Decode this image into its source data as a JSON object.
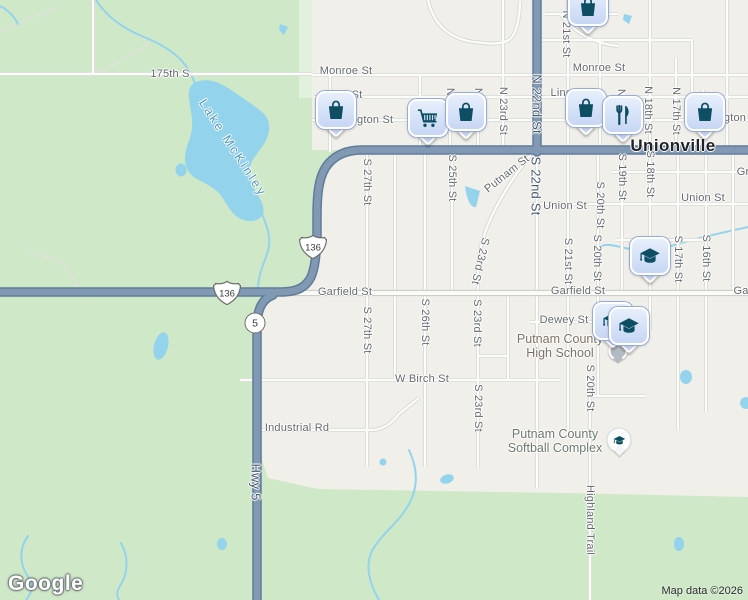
{
  "city_label": "Unionville",
  "water": {
    "lake": "Lake McKinley"
  },
  "pois": {
    "high_school": {
      "line1": "Putnam County",
      "line2": "High School"
    },
    "softball_complex": {
      "line1": "Putnam County",
      "line2": "Softball Complex"
    }
  },
  "routes": {
    "hwy5": "Hwy 5",
    "n22nd": "N 22nd St",
    "s22nd": "S 22nd St"
  },
  "shields": {
    "us136": "136",
    "route5": "5"
  },
  "streets": {
    "s175th": "175th S",
    "monroe": "Monroe St",
    "linc_partial": "Linc",
    "st_partial": "St",
    "ngton_partial": "ngton St",
    "gton_partial": "gton",
    "gr_partial": "Gr",
    "gar_partial": "Gar",
    "union": "Union St",
    "garfield": "Garfield St",
    "dewey": "Dewey St",
    "wbirch": "W Birch St",
    "industrial": "Industrial Rd",
    "putnam": "Putnam St",
    "highland": "Highland Trail",
    "n_partial": "N",
    "n21st": "N 21st St",
    "n23rd": "N 23rd St",
    "n18th": "N 18th St",
    "n17th": "N 17th St",
    "s27th": "S 27th St",
    "s26th": "S 26th St",
    "s25th": "S 25th St",
    "s23rd": "S 23rd St",
    "s21st": "S 21st St",
    "s20th": "S 20th St",
    "s19th": "S 19th St",
    "s18th": "S 18th St",
    "s17th": "S 17th St",
    "s16th": "S 16th St"
  },
  "marker_icons": {
    "bag": "shopping-bag",
    "cart": "shopping-cart",
    "restaurant": "fork-and-knife",
    "education": "graduation-cap"
  },
  "colors": {
    "land_green": "#cfe9c8",
    "urban": "#f1efe9",
    "water": "#93d3ec",
    "road_major": "#8199b3",
    "marker_glyph": "#0d4e63",
    "marker_bubble": "#d2dff7"
  },
  "attribution": {
    "logo": "Google",
    "notice": "Map data ©2026"
  }
}
